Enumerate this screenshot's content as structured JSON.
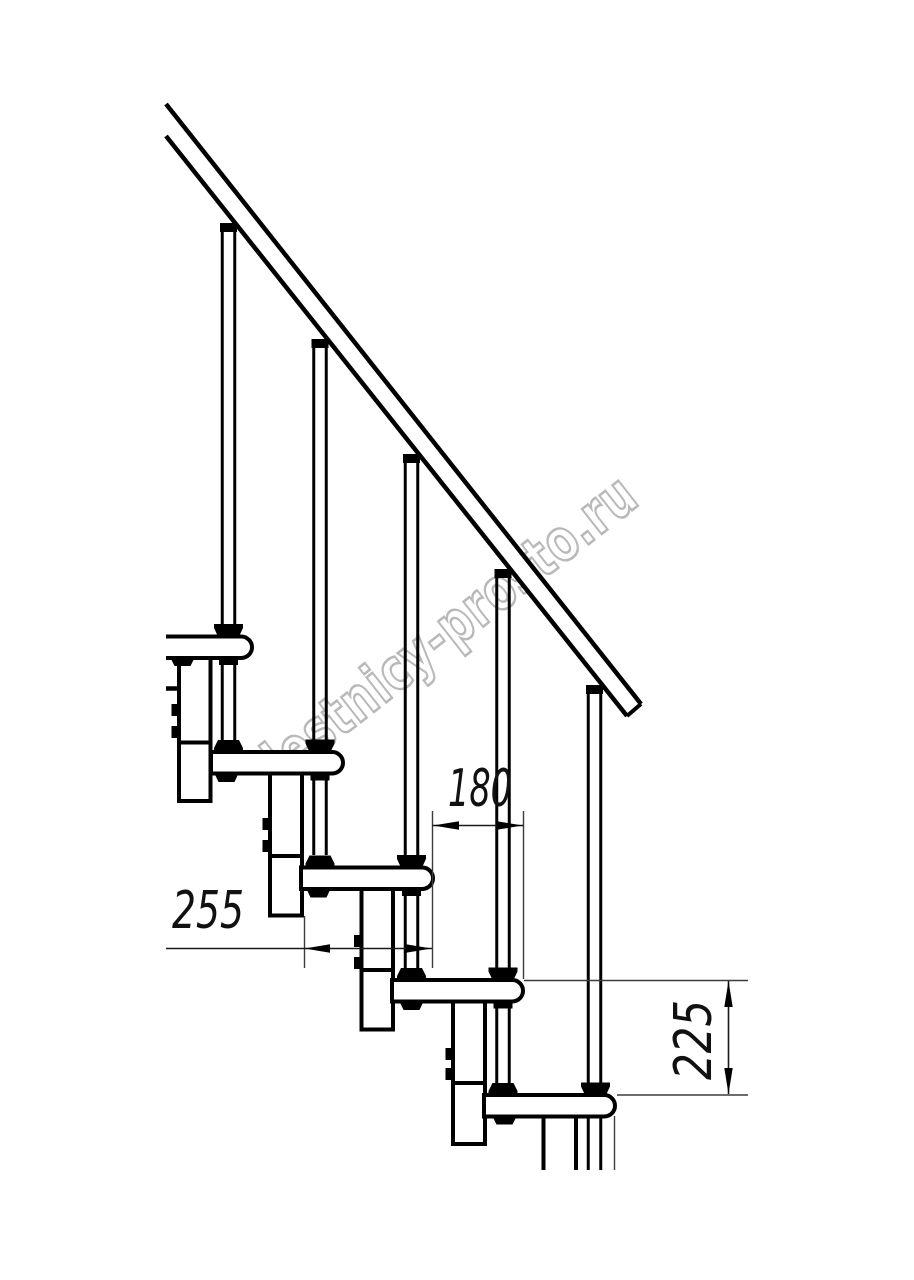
{
  "drawing": {
    "title": "modular-staircase-side-elevation",
    "watermark": "lestnicy-prosto.ru",
    "dimensions": {
      "tread_depth": "255",
      "step_going": "180",
      "step_rise": "225"
    },
    "colors": {
      "line": "#000000",
      "thin_line": "#3c3c3c",
      "watermark": "#b9b9b9",
      "background": "#ffffff"
    }
  }
}
